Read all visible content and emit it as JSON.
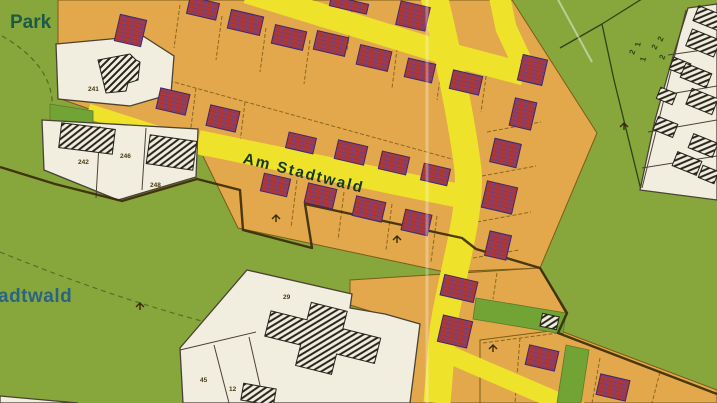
{
  "labels": {
    "park": "Park",
    "forest": "Stadtwald",
    "street": "Am Stadtwald"
  },
  "parcels": {
    "n241": "241",
    "n242": "242",
    "n246": "246",
    "n248": "248",
    "n45": "45",
    "n12": "12",
    "n29": "29"
  },
  "green_markings": [
    "2",
    "1",
    "2",
    "2",
    "1",
    "2"
  ],
  "colors": {
    "green": "#87a73d",
    "greenstrip": "#72a335",
    "hedge": "#55702a",
    "orange": "#e3a84c",
    "road": "#efe22b",
    "white": "#f1eee0",
    "purple": "#5a3f9c",
    "purpleedge": "#3c2a6e",
    "redhatch": "#b5382c",
    "hatchdark": "#26231a",
    "plotline": "#7b5c17",
    "boundary": "#3a2a06",
    "outline": "#4a4234",
    "fieldline": "#2f4316",
    "parktext": "#1d5a46",
    "foresttext": "#2a6480",
    "streettext": "#16381f",
    "tinytext": "#463a10"
  }
}
